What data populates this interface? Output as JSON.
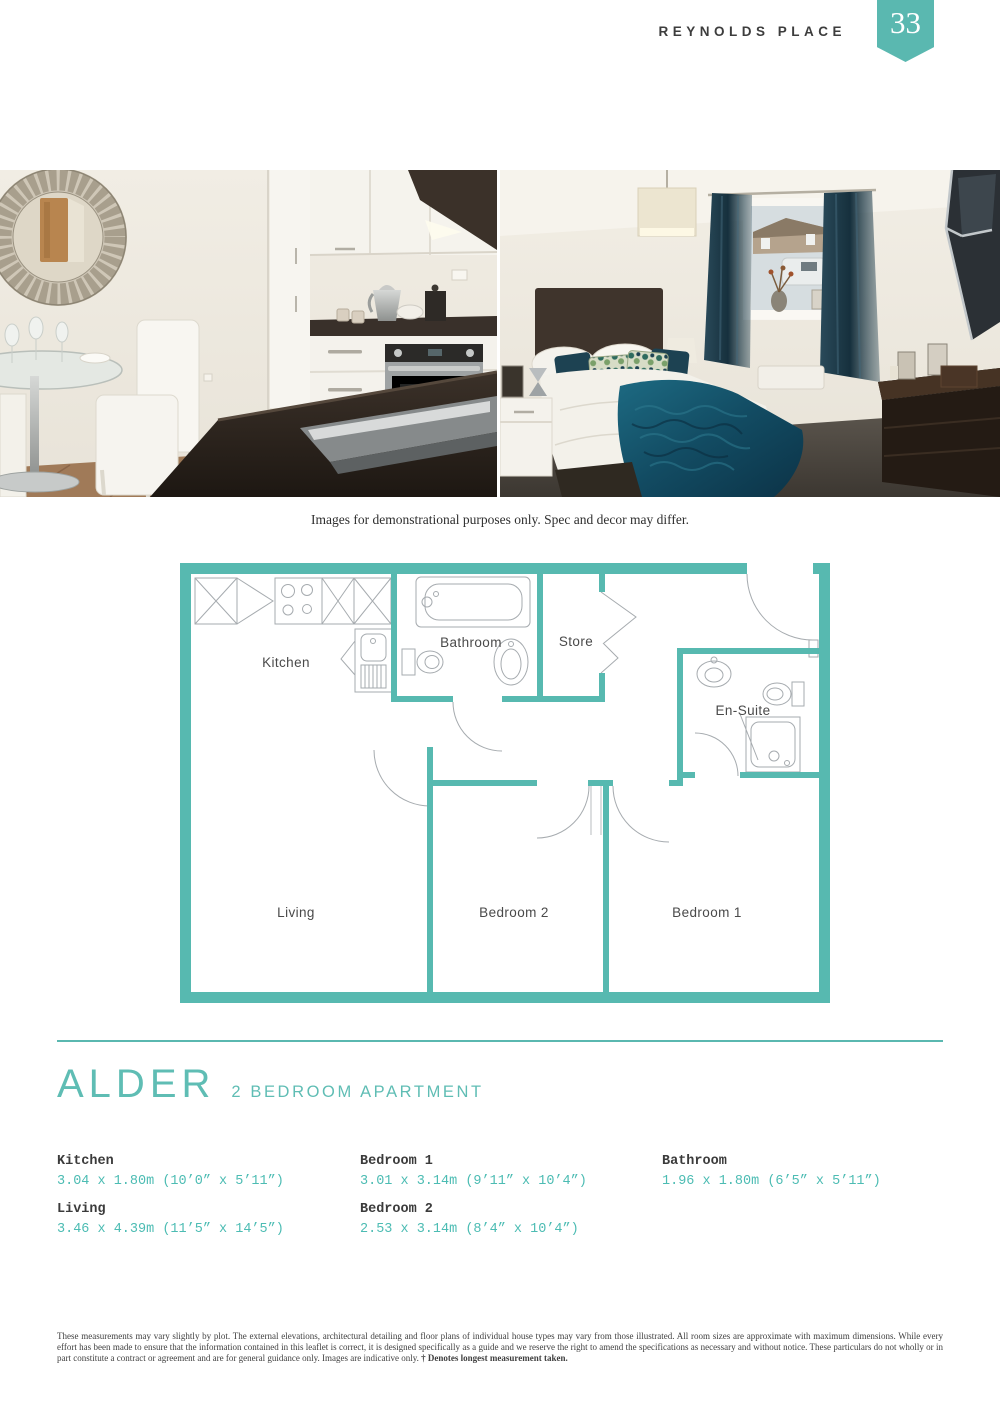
{
  "header": {
    "development_name": "REYNOLDS PLACE",
    "page_number": "33"
  },
  "gallery": {
    "caption": "Images for demonstrational purposes only. Spec and decor may differ."
  },
  "floorplan": {
    "labels": {
      "kitchen": "Kitchen",
      "bathroom": "Bathroom",
      "store": "Store",
      "ensuite": "En-Suite",
      "living": "Living",
      "bedroom2": "Bedroom 2",
      "bedroom1": "Bedroom 1"
    }
  },
  "plot": {
    "name": "ALDER",
    "subtitle": "2 BEDROOM APARTMENT"
  },
  "dimensions": {
    "columns": [
      {
        "rooms": [
          {
            "name": "Kitchen",
            "size": "3.04 x 1.80m (10’0” x 5’11”)"
          },
          {
            "name": "Living",
            "size": "3.46 x 4.39m (11’5” x 14’5”)"
          }
        ]
      },
      {
        "rooms": [
          {
            "name": "Bedroom 1",
            "size": "3.01 x 3.14m (9’11” x 10’4”)"
          },
          {
            "name": "Bedroom 2",
            "size": "2.53 x 3.14m (8’4” x 10’4”)"
          }
        ]
      },
      {
        "rooms": [
          {
            "name": "Bathroom",
            "size": "1.96 x 1.80m (6’5” x 5’11”)"
          }
        ]
      }
    ]
  },
  "footer": {
    "disclaimer": "These measurements may vary slightly by plot. The external elevations, architectural detailing and floor plans of individual house types may vary from those illustrated. All room sizes are approximate with maximum dimensions. While every effort has been made to ensure that the information contained in this leaflet is correct, it is designed specifically as a guide and we reserve the right to amend the specifications as necessary and without notice. These particulars do not wholly or in part constitute a contract or agreement and are for general guidance only. Images are indicative only. ",
    "disclaimer_bold": "† Denotes longest measurement taken."
  },
  "colors": {
    "accent_teal": "#5ab8b0",
    "dimension_teal": "#4cbcb3",
    "text_dark": "#3d3d3d"
  }
}
